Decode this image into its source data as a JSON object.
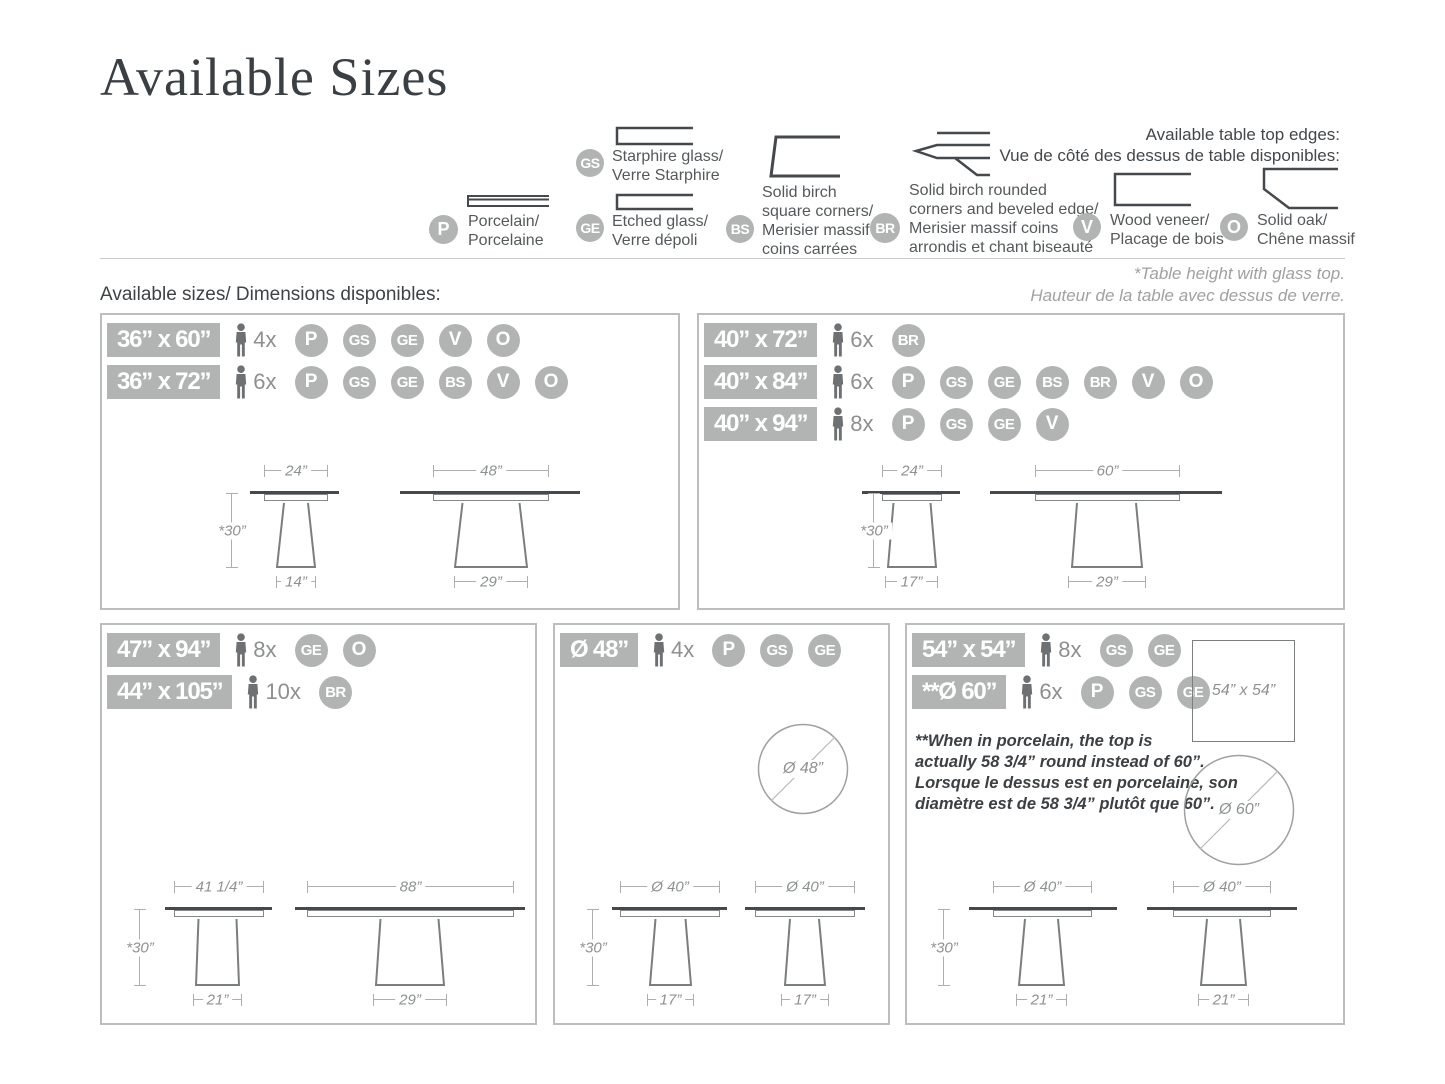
{
  "title": "Available Sizes",
  "legend": {
    "heading_lines": [
      "Available table top edges:",
      "Vue de côté des dessus de table disponibles:"
    ],
    "items": {
      "P": {
        "code": "P",
        "lines": [
          "Porcelain/",
          "Porcelaine"
        ]
      },
      "GS": {
        "code": "GS",
        "lines": [
          "Starphire glass/",
          "Verre Starphire"
        ]
      },
      "GE": {
        "code": "GE",
        "lines": [
          "Etched glass/",
          "Verre dépoli"
        ]
      },
      "BS": {
        "code": "BS",
        "lines": [
          "Solid birch",
          "square corners/",
          "Merisier massif",
          "coins carrées"
        ]
      },
      "BR": {
        "code": "BR",
        "lines": [
          "Solid birch rounded",
          "corners and beveled edge/",
          "Merisier massif coins",
          "arrondis et chant biseauté"
        ]
      },
      "V": {
        "code": "V",
        "lines": [
          "Wood veneer/",
          "Placage de bois"
        ]
      },
      "O": {
        "code": "O",
        "lines": [
          "Solid oak/",
          "Chêne massif"
        ]
      }
    }
  },
  "section": {
    "available_sizes": "Available sizes/ Dimensions disponibles:",
    "glass_note_lines": [
      "*Table height with glass top.",
      "Hauteur de la table avec dessus de verre."
    ]
  },
  "panels": [
    {
      "rows": [
        {
          "size": "36” x 60”",
          "qty": "4x",
          "mats": [
            "P",
            "GS",
            "GE",
            "V",
            "O"
          ]
        },
        {
          "size": "36” x 72”",
          "qty": "6x",
          "mats": [
            "P",
            "GS",
            "GE",
            "BS",
            "V",
            "O"
          ]
        }
      ],
      "diagrams": [
        {
          "top": "24”",
          "height": "*30”",
          "base": "14”"
        },
        {
          "top": "48”",
          "base": "29”"
        }
      ]
    },
    {
      "rows": [
        {
          "size": "40” x 72”",
          "qty": "6x",
          "mats": [
            "BR"
          ]
        },
        {
          "size": "40” x 84”",
          "qty": "6x",
          "mats": [
            "P",
            "GS",
            "GE",
            "BS",
            "BR",
            "V",
            "O"
          ]
        },
        {
          "size": "40” x 94”",
          "qty": "8x",
          "mats": [
            "P",
            "GS",
            "GE",
            "V"
          ]
        }
      ],
      "diagrams": [
        {
          "top": "24”",
          "height": "*30”",
          "base": "17”"
        },
        {
          "top": "60”",
          "base": "29”"
        }
      ]
    },
    {
      "rows": [
        {
          "size": "47” x 94”",
          "qty": "8x",
          "mats": [
            "GE",
            "O"
          ]
        },
        {
          "size": "44” x 105”",
          "qty": "10x",
          "mats": [
            "BR"
          ]
        }
      ],
      "diagrams": [
        {
          "top": "41 1/4”",
          "height": "*30”",
          "base": "21”"
        },
        {
          "top": "88”",
          "base": "29”"
        }
      ]
    },
    {
      "rows": [
        {
          "size": "Ø 48”",
          "qty": "4x",
          "mats": [
            "P",
            "GS",
            "GE"
          ]
        }
      ],
      "circle": "Ø 48”",
      "diagrams": [
        {
          "top": "Ø 40”",
          "height": "*30”",
          "base": "17”"
        },
        {
          "top": "Ø 40”",
          "base": "17”"
        }
      ]
    },
    {
      "rows": [
        {
          "size": "54” x 54”",
          "qty": "8x",
          "mats": [
            "GS",
            "GE"
          ]
        },
        {
          "size": "**Ø 60”",
          "qty": "6x",
          "mats": [
            "P",
            "GS",
            "GE"
          ]
        }
      ],
      "square": "54” x 54”",
      "circle": "Ø 60”",
      "note_lines": [
        "**When in porcelain, the top is",
        "actually 58 3/4” round instead of 60”.",
        "Lorsque le dessus est en porcelaine, son",
        "diamètre est de 58 3/4” plutôt que 60”."
      ],
      "diagrams": [
        {
          "top": "Ø 40”",
          "height": "*30”",
          "base": "21”"
        },
        {
          "top": "Ø 40”",
          "base": "21”"
        }
      ]
    }
  ]
}
